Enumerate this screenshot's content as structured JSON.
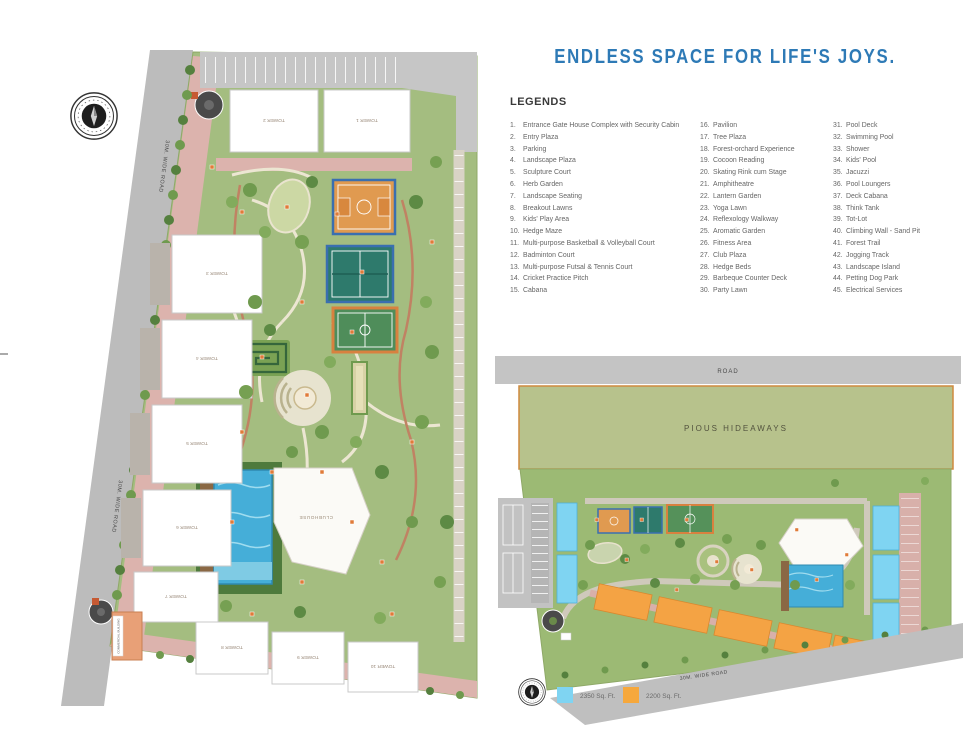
{
  "title": "ENDLESS SPACE FOR LIFE'S JOYS.",
  "colors": {
    "title_blue": "#2e7ab6",
    "swatch_blue": "#7fd4f2",
    "swatch_orange": "#f6a83c"
  },
  "legends": {
    "heading": "LEGENDS",
    "columns": [
      [
        {
          "n": "1.",
          "label": "Entrance Gate House Complex with Security Cabin"
        },
        {
          "n": "2.",
          "label": "Entry Plaza"
        },
        {
          "n": "3.",
          "label": "Parking"
        },
        {
          "n": "4.",
          "label": "Landscape Plaza"
        },
        {
          "n": "5.",
          "label": "Sculpture Court"
        },
        {
          "n": "6.",
          "label": "Herb Garden"
        },
        {
          "n": "7.",
          "label": "Landscape Seating"
        },
        {
          "n": "8.",
          "label": "Breakout Lawns"
        },
        {
          "n": "9.",
          "label": "Kids' Play Area"
        },
        {
          "n": "10.",
          "label": "Hedge Maze"
        },
        {
          "n": "11.",
          "label": "Multi-purpose Basketball & Volleyball Court"
        },
        {
          "n": "12.",
          "label": "Badminton Court"
        },
        {
          "n": "13.",
          "label": "Multi-purpose Futsal & Tennis Court"
        },
        {
          "n": "14.",
          "label": "Cricket Practice Pitch"
        },
        {
          "n": "15.",
          "label": "Cabana"
        }
      ],
      [
        {
          "n": "16.",
          "label": "Pavilion"
        },
        {
          "n": "17.",
          "label": "Tree Plaza"
        },
        {
          "n": "18.",
          "label": "Forest-orchard Experience"
        },
        {
          "n": "19.",
          "label": "Cocoon Reading"
        },
        {
          "n": "20.",
          "label": "Skating Rink cum Stage"
        },
        {
          "n": "21.",
          "label": "Amphitheatre"
        },
        {
          "n": "22.",
          "label": "Lantern Garden"
        },
        {
          "n": "23.",
          "label": "Yoga Lawn"
        },
        {
          "n": "24.",
          "label": "Reflexology Walkway"
        },
        {
          "n": "25.",
          "label": "Aromatic Garden"
        },
        {
          "n": "26.",
          "label": "Fitness Area"
        },
        {
          "n": "27.",
          "label": "Club Plaza"
        },
        {
          "n": "28.",
          "label": "Hedge Beds"
        },
        {
          "n": "29.",
          "label": "Barbeque Counter Deck"
        },
        {
          "n": "30.",
          "label": "Party Lawn"
        }
      ],
      [
        {
          "n": "31.",
          "label": "Pool Deck"
        },
        {
          "n": "32.",
          "label": "Swimming Pool"
        },
        {
          "n": "33.",
          "label": "Shower"
        },
        {
          "n": "34.",
          "label": "Kids' Pool"
        },
        {
          "n": "35.",
          "label": "Jacuzzi"
        },
        {
          "n": "36.",
          "label": "Pool Loungers"
        },
        {
          "n": "37.",
          "label": "Deck Cabana"
        },
        {
          "n": "38.",
          "label": "Think Tank"
        },
        {
          "n": "39.",
          "label": "Tot-Lot"
        },
        {
          "n": "40.",
          "label": "Climbing Wall - Sand Pit"
        },
        {
          "n": "41.",
          "label": "Forest Trail"
        },
        {
          "n": "42.",
          "label": "Jogging Track"
        },
        {
          "n": "43.",
          "label": "Landscape Island"
        },
        {
          "n": "44.",
          "label": "Petting Dog Park"
        },
        {
          "n": "45.",
          "label": "Electrical Services"
        }
      ]
    ]
  },
  "map1": {
    "road_label_upper": "30M. WIDE ROAD",
    "road_label_lower": "30M. WIDE ROAD",
    "towers": [
      "TOWER 2",
      "TOWER 1",
      "TOWER 3",
      "TOWER 4",
      "TOWER 5",
      "TOWER 6",
      "TOWER 7",
      "TOWER 8",
      "TOWER 9",
      "TOWER 10"
    ],
    "clubhouse_label": "CLUBHOUSE",
    "commercial_label": "COMMERCIAL BUILDING"
  },
  "map2": {
    "road_top": "ROAD",
    "road_bottom": "30M. WIDE ROAD",
    "neighbor_label": "PIOUS HIDEAWAYS",
    "legend": [
      {
        "color": "#7fd4f2",
        "label": "2350 Sq. Ft."
      },
      {
        "color": "#f6a83c",
        "label": "2200 Sq. Ft."
      }
    ]
  }
}
